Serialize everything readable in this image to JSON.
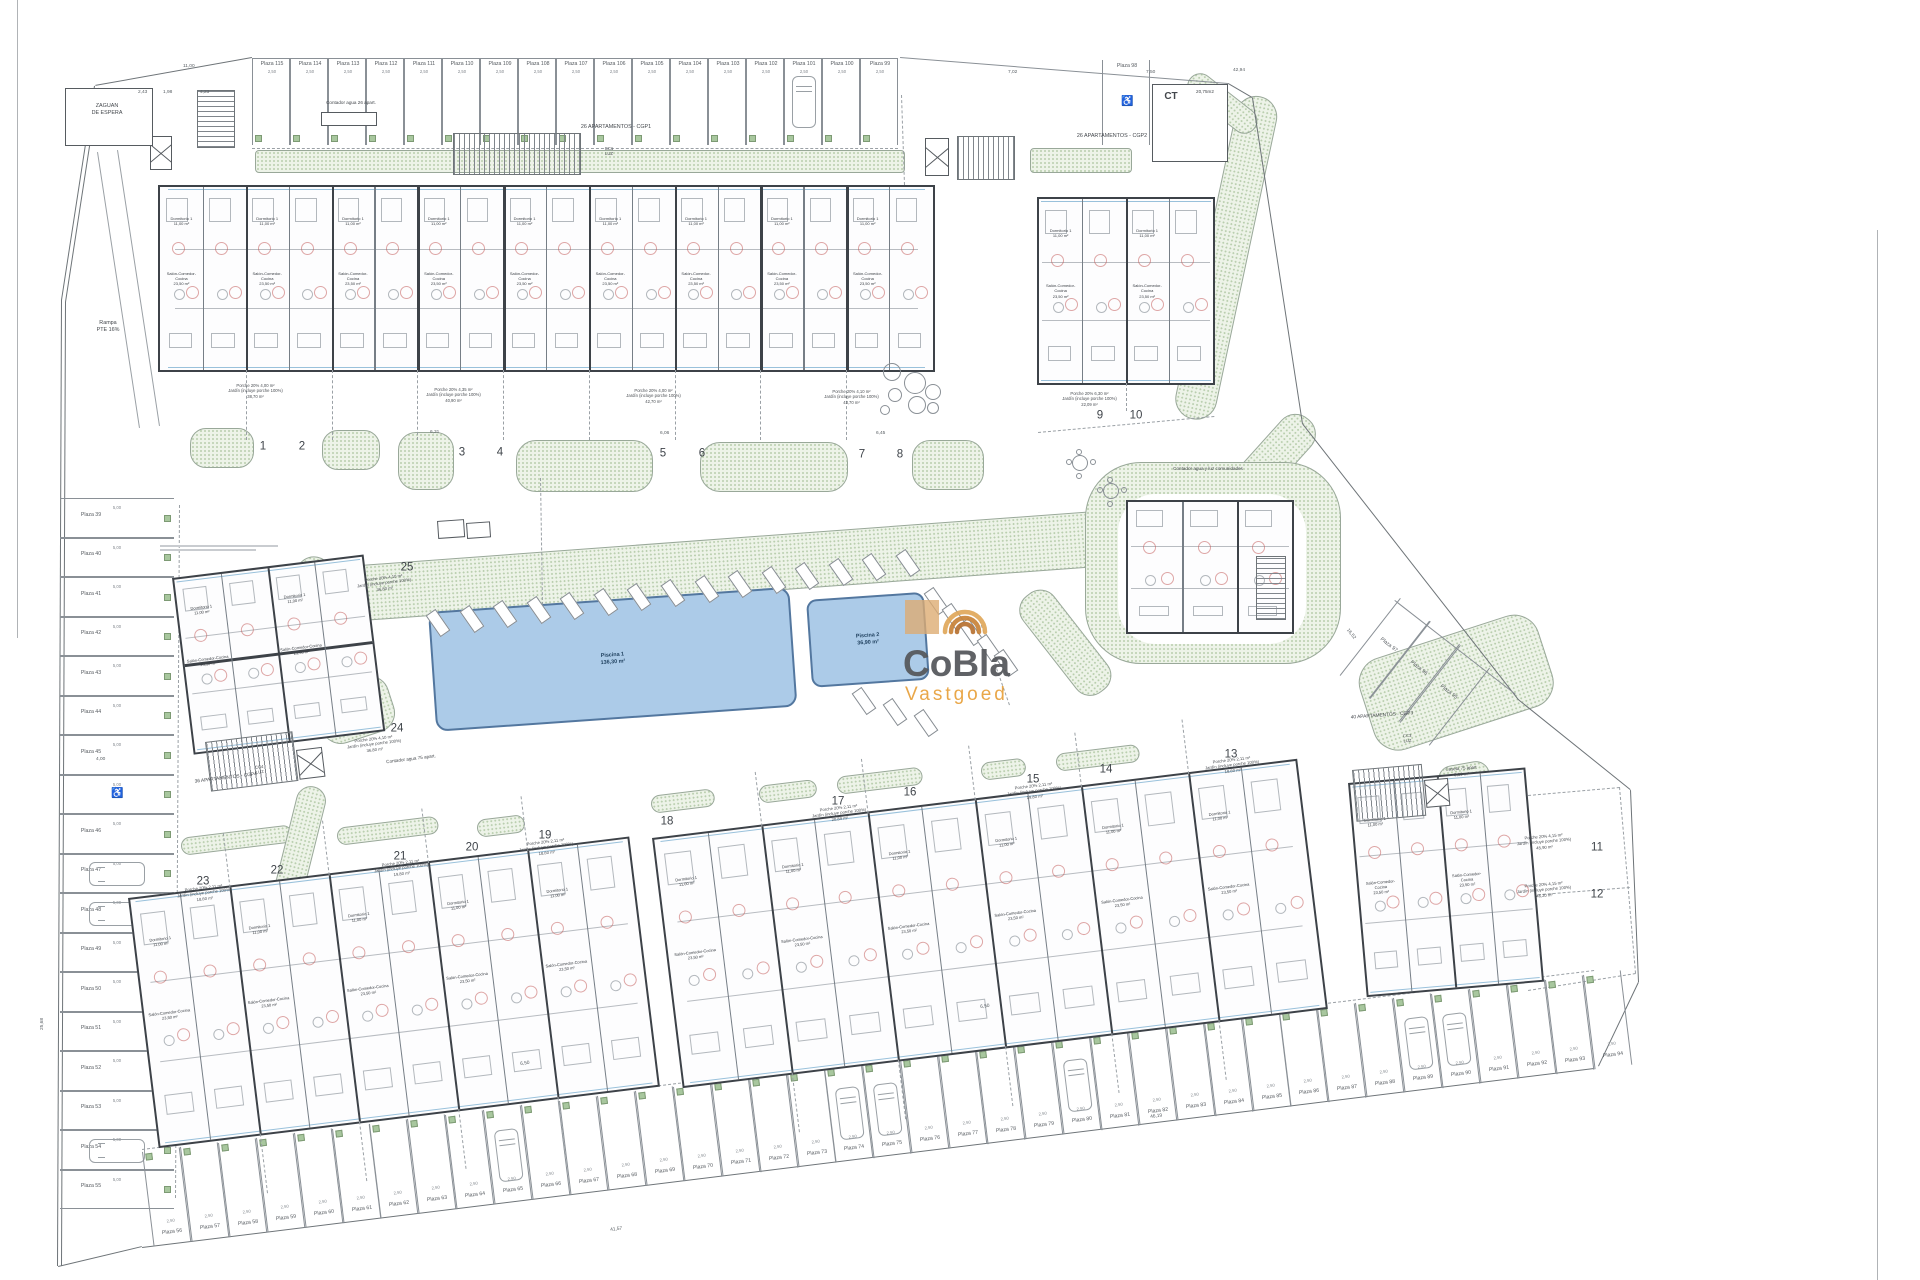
{
  "canvas": {
    "w": 1920,
    "h": 1280
  },
  "palette": {
    "wall": "#3d4248",
    "line": "#8a9096",
    "green_fill": "#edf3e8",
    "green_dot": "#b9ceae",
    "pool_fill": "#accbe8",
    "pool_edge": "#53779f",
    "red_arc": "#c0504d",
    "facade_glass": "#7fb2d2",
    "logo_dark": "#55575b",
    "logo_orange": "#e8a13c"
  },
  "logo": {
    "line1": "CoBla",
    "line2": "Vastgoed",
    "icon": "swirl-arcs-icon"
  },
  "labels": [
    {
      "id": "zaguan",
      "t": "ZAGUAN\nDE ESPERA",
      "x": 70,
      "y": 103,
      "s": 5.4,
      "w": 74
    },
    {
      "id": "rampa",
      "t": "Rampa\nPTE 16%",
      "x": 78,
      "y": 320,
      "s": 5.4,
      "w": 60
    },
    {
      "id": "contador26",
      "t": "Contador agua 26 apart.",
      "x": 306,
      "y": 100,
      "s": 4.6,
      "w": 90
    },
    {
      "id": "cgp1",
      "t": "26 APARTAMENTOS - CGP1",
      "x": 550,
      "y": 124,
      "s": 5.4,
      "w": 132
    },
    {
      "id": "cc1",
      "t": "CC1\nLUZ",
      "x": 596,
      "y": 146,
      "s": 4.2,
      "w": 26
    },
    {
      "id": "cgp2",
      "t": "26 APARTAMENTOS - CGP2",
      "x": 1046,
      "y": 133,
      "s": 5.4,
      "w": 132
    },
    {
      "id": "ct",
      "t": "CT",
      "x": 1158,
      "y": 90,
      "s": 10,
      "w": 26,
      "b": 1
    },
    {
      "id": "ct_area",
      "t": "20,75m2",
      "x": 1188,
      "y": 89,
      "s": 4.6,
      "w": 34
    },
    {
      "id": "comunidades",
      "t": "Contador agua y luz comunidades",
      "x": 1140,
      "y": 466,
      "s": 4.6,
      "w": 136
    },
    {
      "id": "cgp3",
      "t": "40 APARTAMENTOS - CGP3",
      "x": 1316,
      "y": 718,
      "s": 4.8,
      "w": 132,
      "r": -4
    },
    {
      "id": "cc3",
      "t": "CC3\nLUZ",
      "x": 1394,
      "y": 734,
      "s": 4.2,
      "w": 26,
      "r": -4
    },
    {
      "id": "caseta",
      "t": "Caseta 75 apart\n3,00 m²",
      "x": 1428,
      "y": 768,
      "s": 4.4,
      "w": 66,
      "r": -4
    },
    {
      "id": "cgp4",
      "t": "36 APARTAMENTOS - CGP4",
      "x": 160,
      "y": 784,
      "s": 4.8,
      "w": 132,
      "r": -7
    },
    {
      "id": "cc4",
      "t": "CC4\nLUZ",
      "x": 246,
      "y": 766,
      "s": 4.2,
      "w": 26,
      "r": -7
    },
    {
      "id": "contador75",
      "t": "Contador agua 75 apart.",
      "x": 364,
      "y": 762,
      "s": 4.6,
      "w": 94,
      "r": -7
    }
  ],
  "rooms": [
    "Dormitorio 1\n11,00 m²",
    "Salón-Comedor-Cocina\n23,50 m²",
    "Dormitorio 2\n10,70 m²",
    "Baño 1\n3,90 m²",
    "Paso\n4,60 m²"
  ],
  "micro_prefix": {
    "porche": "Porche 20%",
    "jardin": "Jardín (incluye porche 100%)"
  },
  "building_numbers": [
    {
      "n": "1",
      "x": 263,
      "y": 447,
      "p": "4,00 m²",
      "j": "38,70 m²",
      "lx": 208,
      "ly": 383,
      "lr": 0
    },
    {
      "n": "2",
      "x": 302,
      "y": 447
    },
    {
      "n": "3",
      "x": 462,
      "y": 453,
      "p": "4,35 m²",
      "j": "40,90 m²",
      "lx": 406,
      "ly": 387,
      "lr": 0
    },
    {
      "n": "4",
      "x": 500,
      "y": 453
    },
    {
      "n": "5",
      "x": 663,
      "y": 454,
      "p": "4,00 m²",
      "j": "42,70 m²",
      "lx": 606,
      "ly": 388,
      "lr": 0
    },
    {
      "n": "6",
      "x": 702,
      "y": 454
    },
    {
      "n": "7",
      "x": 862,
      "y": 455,
      "p": "4,10 m²",
      "j": "43,70 m²",
      "lx": 804,
      "ly": 389,
      "lr": 0
    },
    {
      "n": "8",
      "x": 900,
      "y": 455
    },
    {
      "n": "9",
      "x": 1100,
      "y": 416,
      "p": "6,30 m²",
      "j": "22,09 m²",
      "lx": 1042,
      "ly": 391,
      "lr": 0
    },
    {
      "n": "10",
      "x": 1136,
      "y": 416
    },
    {
      "n": "11",
      "x": 1597,
      "y": 848,
      "p": "4,15 m²",
      "j": "45,90 m²",
      "lx": 1496,
      "ly": 838,
      "lr": -5
    },
    {
      "n": "12",
      "x": 1597,
      "y": 895,
      "p": "4,15 m²",
      "j": "46,20 m²",
      "lx": 1496,
      "ly": 886,
      "lr": -5
    },
    {
      "n": "13",
      "x": 1231,
      "y": 755,
      "p": "2,11 m²",
      "j": "18,60 m²",
      "lx": 1184,
      "ly": 763,
      "lr": -7
    },
    {
      "n": "14",
      "x": 1106,
      "y": 770
    },
    {
      "n": "15",
      "x": 1033,
      "y": 780,
      "p": "2,11 m²",
      "j": "19,80 m²",
      "lx": 986,
      "ly": 789,
      "lr": -7
    },
    {
      "n": "16",
      "x": 910,
      "y": 793
    },
    {
      "n": "17",
      "x": 838,
      "y": 802,
      "p": "2,11 m²",
      "j": "20,89 m²",
      "lx": 791,
      "ly": 811,
      "lr": -7
    },
    {
      "n": "18",
      "x": 667,
      "y": 822
    },
    {
      "n": "19",
      "x": 545,
      "y": 836,
      "p": "2,11 m²",
      "j": "18,60 m²",
      "lx": 498,
      "ly": 845,
      "lr": -7
    },
    {
      "n": "20",
      "x": 472,
      "y": 848
    },
    {
      "n": "21",
      "x": 400,
      "y": 857,
      "p": "2,11 m²",
      "j": "19,80 m²",
      "lx": 353,
      "ly": 866,
      "lr": -7
    },
    {
      "n": "22",
      "x": 277,
      "y": 871
    },
    {
      "n": "23",
      "x": 203,
      "y": 882,
      "p": "2,11 m²",
      "j": "18,60 m²",
      "lx": 156,
      "ly": 891,
      "lr": -7
    },
    {
      "n": "24",
      "x": 397,
      "y": 729,
      "p": "4,10 m²",
      "j": "36,80 m²",
      "lx": 326,
      "ly": 742,
      "lr": -7
    },
    {
      "n": "25",
      "x": 407,
      "y": 568,
      "p": "4,10 m²",
      "j": "36,80 m²",
      "lx": 336,
      "ly": 581,
      "lr": -7
    }
  ],
  "buildings": [
    {
      "id": "cgp1-block",
      "x": 158,
      "y": 185,
      "w": 777,
      "h": 187,
      "rot": 0,
      "cols": 18,
      "extDown": 70
    },
    {
      "id": "cgp2-block",
      "x": 1037,
      "y": 197,
      "w": 178,
      "h": 188,
      "rot": 0,
      "cols": 4,
      "extDown": 28
    },
    {
      "id": "block-24-25",
      "x": 172,
      "y": 578,
      "w": 193,
      "h": 178,
      "rot": -7,
      "cols": 4,
      "midWall": true
    },
    {
      "id": "community-building",
      "x": 1126,
      "y": 500,
      "w": 168,
      "h": 134,
      "rot": 0,
      "cols": 3,
      "plain": true
    },
    {
      "id": "block-19-23",
      "x": 128,
      "y": 898,
      "w": 505,
      "h": 252,
      "rot": -7,
      "cols": 10,
      "extUp": 55,
      "extDown": 60
    },
    {
      "id": "block-13-18",
      "x": 652,
      "y": 838,
      "w": 650,
      "h": 252,
      "rot": -7,
      "cols": 12,
      "extUp": 55,
      "extDown": 60
    },
    {
      "id": "cgp3-block",
      "x": 1348,
      "y": 783,
      "w": 178,
      "h": 215,
      "rot": -5,
      "cols": 4
    }
  ],
  "parking_rows": [
    {
      "id": "top-row",
      "x": 252,
      "y": 58,
      "ang": 0,
      "sw": 38,
      "sh": 87,
      "labelAt": "top",
      "tick": "2,50",
      "planters": true,
      "cars": [
        14
      ],
      "labels": [
        "Plaza 115",
        "Plaza 114",
        "Plaza 113",
        "Plaza 112",
        "Plaza 111",
        "Plaza 110",
        "Plaza 109",
        "Plaza 108",
        "Plaza 107",
        "Plaza 106",
        "Plaza 105",
        "Plaza 104",
        "Plaza 103",
        "Plaza 102",
        "Plaza 101",
        "Plaza 100",
        "Plaza 99"
      ]
    },
    {
      "id": "plaza-98",
      "x": 1102,
      "y": 60,
      "ang": 0,
      "sw": 48,
      "sh": 85,
      "labelAt": "top",
      "disabled": [
        0
      ],
      "labels": [
        "Plaza 98"
      ]
    },
    {
      "id": "left-column",
      "vertical": true,
      "x": 60,
      "y": 498,
      "sw": 114,
      "sh": 39.5,
      "tick": "5,00",
      "planters": true,
      "disabled": [
        7
      ],
      "cars": [
        9,
        10,
        16
      ],
      "labels": [
        "Plaza 39",
        "Plaza 40",
        "Plaza 41",
        "Plaza 42",
        "Plaza 43",
        "Plaza 44",
        "Plaza 45",
        "",
        "Plaza 46",
        "Plaza 47",
        "Plaza 48",
        "Plaza 49",
        "Plaza 50",
        "Plaza 51",
        "Plaza 52",
        "Plaza 53",
        "Plaza 54",
        "Plaza 55"
      ]
    },
    {
      "id": "bottom-row",
      "x": 142,
      "y": 1152,
      "ang": -7,
      "sw": 38.2,
      "sh": 95,
      "labelAt": "bottom",
      "tick": "2,50",
      "planters": true,
      "cars": [
        9,
        18,
        19,
        24,
        33,
        34
      ],
      "labels": [
        "Plaza 56",
        "Plaza 57",
        "Plaza 58",
        "Plaza 59",
        "Plaza 60",
        "Plaza 61",
        "Plaza 62",
        "Plaza 63",
        "Plaza 64",
        "Plaza 65",
        "Plaza 66",
        "Plaza 67",
        "Plaza 68",
        "Plaza 69",
        "Plaza 70",
        "Plaza 71",
        "Plaza 72",
        "Plaza 73",
        "Plaza 74",
        "Plaza 75",
        "Plaza 76",
        "Plaza 77",
        "Plaza 78",
        "Plaza 79",
        "Plaza 80",
        "Plaza 81",
        "Plaza 82",
        "Plaza 83",
        "Plaza 84",
        "Plaza 85",
        "Plaza 86",
        "Plaza 87",
        "Plaza 88",
        "Plaza 89",
        "Plaza 90",
        "Plaza 91",
        "Plaza 92",
        "Plaza 93",
        "Plaza 94"
      ]
    },
    {
      "id": "diag-row",
      "x": 1400,
      "y": 598,
      "ang": 38,
      "sw": 38,
      "sh": 98,
      "labelAt": "mid",
      "labels": [
        "Plaza 97",
        "Plaza 96",
        "Plaza 95"
      ]
    }
  ],
  "pools": [
    {
      "label": "Piscina 1",
      "area": "136,30 m²",
      "x": 428,
      "y": 612,
      "w": 362,
      "h": 120,
      "rot": -4,
      "r": 12
    },
    {
      "label": "Piscina 2",
      "area": "36,90 m²",
      "x": 806,
      "y": 600,
      "w": 118,
      "h": 88,
      "rot": -4,
      "r": 10
    }
  ],
  "greens": [
    [
      255,
      150,
      650,
      23,
      0,
      4
    ],
    [
      1030,
      148,
      102,
      25,
      0,
      4
    ],
    [
      1240,
      92,
      42,
      330,
      12,
      21
    ],
    [
      1198,
      68,
      82,
      26,
      38,
      13
    ],
    [
      1294,
      406,
      40,
      152,
      42,
      19
    ],
    [
      292,
      570,
      892,
      56,
      -4.2,
      28
    ],
    [
      300,
      553,
      36,
      168,
      12,
      18
    ],
    [
      310,
      694,
      76,
      58,
      -18,
      20
    ],
    [
      1085,
      462,
      256,
      202,
      0,
      56
    ],
    [
      1352,
      666,
      188,
      96,
      -18,
      26
    ],
    [
      1436,
      768,
      52,
      44,
      -10,
      14
    ],
    [
      190,
      428,
      64,
      40,
      0,
      16
    ],
    [
      322,
      430,
      58,
      40,
      0,
      16
    ],
    [
      398,
      432,
      56,
      58,
      0,
      18
    ],
    [
      516,
      440,
      137,
      52,
      0,
      20
    ],
    [
      700,
      442,
      148,
      50,
      0,
      20
    ],
    [
      912,
      440,
      72,
      50,
      0,
      18
    ],
    [
      180,
      838,
      112,
      18,
      -7,
      9
    ],
    [
      336,
      828,
      102,
      18,
      -7,
      9
    ],
    [
      476,
      820,
      48,
      18,
      -7,
      9
    ],
    [
      650,
      796,
      64,
      18,
      -7,
      9
    ],
    [
      758,
      786,
      58,
      18,
      -7,
      9
    ],
    [
      836,
      777,
      86,
      18,
      -7,
      9
    ],
    [
      980,
      763,
      45,
      18,
      -7,
      9
    ],
    [
      1055,
      754,
      84,
      18,
      -7,
      9
    ],
    [
      300,
      783,
      30,
      122,
      14,
      15
    ],
    [
      1012,
      607,
      40,
      122,
      -38,
      18
    ]
  ],
  "whites": [
    [
      1118,
      494,
      188,
      150,
      38
    ]
  ],
  "lounger_rows": [
    {
      "x1": 432,
      "y1": 610,
      "x2": 902,
      "y2": 550,
      "n": 15,
      "rot": -35
    },
    {
      "x1": 930,
      "y1": 588,
      "x2": 1000,
      "y2": 650,
      "n": 5,
      "rot": -35
    },
    {
      "x1": 858,
      "y1": 688,
      "x2": 920,
      "y2": 710,
      "n": 3,
      "rot": -35
    }
  ],
  "stairs": [
    {
      "x": 453,
      "y": 133,
      "w": 128,
      "h": 42,
      "rot": 0
    },
    {
      "x": 197,
      "y": 90,
      "w": 38,
      "h": 58,
      "rot": 0,
      "h_stripes": true
    },
    {
      "x": 957,
      "y": 136,
      "w": 58,
      "h": 44,
      "rot": 0
    },
    {
      "x": 205,
      "y": 742,
      "w": 88,
      "h": 50,
      "rot": -7
    },
    {
      "x": 1352,
      "y": 770,
      "w": 70,
      "h": 52,
      "rot": -5
    },
    {
      "x": 1256,
      "y": 556,
      "w": 30,
      "h": 64,
      "rot": 0,
      "h_stripes": true
    }
  ],
  "xboxes": [
    [
      150,
      136,
      22,
      34,
      0
    ],
    [
      925,
      138,
      24,
      38,
      0
    ],
    [
      296,
      750,
      26,
      30,
      -7
    ],
    [
      1424,
      780,
      24,
      28,
      -5
    ],
    [
      1172,
      106,
      38,
      44,
      0
    ]
  ],
  "boxes": [
    [
      65,
      88,
      88,
      58,
      0
    ],
    [
      1152,
      84,
      76,
      78,
      0
    ],
    [
      321,
      112,
      56,
      14,
      0
    ],
    [
      437,
      521,
      27,
      18,
      -4
    ],
    [
      466,
      523,
      24,
      16,
      -4
    ]
  ],
  "tables": [
    [
      1072,
      455
    ],
    [
      1103,
      483
    ]
  ],
  "bushes": [
    [
      883,
      363,
      18
    ],
    [
      904,
      372,
      22
    ],
    [
      925,
      384,
      16
    ],
    [
      888,
      388,
      14
    ],
    [
      908,
      396,
      18
    ],
    [
      927,
      402,
      12
    ],
    [
      880,
      405,
      10
    ]
  ],
  "dimensions": [
    {
      "t": "11,00",
      "x": 183,
      "y": 64
    },
    {
      "t": "7,02",
      "x": 1008,
      "y": 70
    },
    {
      "t": "7,50",
      "x": 1146,
      "y": 70
    },
    {
      "t": "42,94",
      "x": 1233,
      "y": 68
    },
    {
      "t": "2,43",
      "x": 138,
      "y": 90
    },
    {
      "t": "1,98",
      "x": 163,
      "y": 90
    },
    {
      "t": "4,23",
      "x": 200,
      "y": 90
    },
    {
      "t": "6,31",
      "x": 430,
      "y": 430
    },
    {
      "t": "6,06",
      "x": 660,
      "y": 431
    },
    {
      "t": "6,45",
      "x": 876,
      "y": 431
    },
    {
      "t": "4,00",
      "x": 96,
      "y": 757
    },
    {
      "t": "25,68",
      "x": 40,
      "y": 1030,
      "r": -90
    },
    {
      "t": "41,57",
      "x": 610,
      "y": 1228,
      "r": -7
    },
    {
      "t": "46,19",
      "x": 1150,
      "y": 1115,
      "r": -7
    },
    {
      "t": "6,50",
      "x": 520,
      "y": 1062,
      "r": -7
    },
    {
      "t": "6,50",
      "x": 980,
      "y": 1005,
      "r": -7
    },
    {
      "t": "16,52",
      "x": 1349,
      "y": 628,
      "r": 52
    }
  ],
  "boundary": [
    [
      18,
      0,
      18,
      638,
      1,
      "#b0b3b6",
      0
    ],
    [
      1878,
      230,
      1878,
      1280,
      1,
      "#b0b3b6",
      0
    ],
    [
      95,
      86,
      62,
      300,
      1.4,
      "#6e7478",
      0
    ],
    [
      99,
      88,
      66,
      302,
      1.4,
      "#6e7478",
      0
    ],
    [
      62,
      300,
      58,
      1266,
      1.4,
      "#6e7478",
      0
    ],
    [
      66,
      302,
      62,
      1266,
      1.4,
      "#6e7478",
      0
    ],
    [
      58,
      1266,
      142,
      1246,
      1.4,
      "#6e7478",
      0
    ],
    [
      142,
      1247,
      1594,
      1068,
      1.2,
      "#6e7478",
      0
    ],
    [
      1598,
      1066,
      1638,
      982,
      1.2,
      "#6e7478",
      0
    ],
    [
      1638,
      982,
      1630,
      790,
      1.2,
      "#6e7478",
      0
    ],
    [
      1630,
      790,
      1518,
      700,
      1.2,
      "#6e7478",
      0
    ],
    [
      1518,
      700,
      1302,
      424,
      1.2,
      "#6e7478",
      0
    ],
    [
      1302,
      424,
      1252,
      98,
      1.2,
      "#6e7478",
      0
    ],
    [
      1252,
      98,
      1228,
      84,
      1.2,
      "#6e7478",
      0
    ],
    [
      1228,
      84,
      900,
      58,
      1,
      "#8a9096",
      0
    ],
    [
      252,
      58,
      898,
      58,
      1,
      "#8a9096",
      0
    ],
    [
      252,
      58,
      95,
      86,
      1.2,
      "#6e7478",
      0
    ],
    [
      98,
      152,
      140,
      428,
      0.8,
      "#9aa0a5",
      0
    ],
    [
      118,
      150,
      160,
      426,
      0.8,
      "#9aa0a5",
      0
    ],
    [
      1395,
      600,
      1516,
      694,
      1,
      "#8a9096",
      0
    ]
  ],
  "dashes": [
    [
      541,
      478,
      543,
      605
    ],
    [
      980,
      620,
      1010,
      705
    ],
    [
      902,
      95,
      905,
      185
    ],
    [
      252,
      148,
      898,
      148
    ],
    [
      180,
      505,
      176,
      1198
    ],
    [
      142,
      1149,
      1594,
      970
    ],
    [
      1038,
      432,
      1214,
      416
    ],
    [
      1528,
      795,
      1620,
      787
    ],
    [
      1620,
      787,
      1636,
      973
    ],
    [
      1528,
      990,
      1636,
      973
    ],
    [
      1528,
      895,
      1630,
      887
    ]
  ],
  "greek_notes": [
    [
      160,
      545,
      118
    ],
    [
      160,
      549,
      96
    ]
  ]
}
